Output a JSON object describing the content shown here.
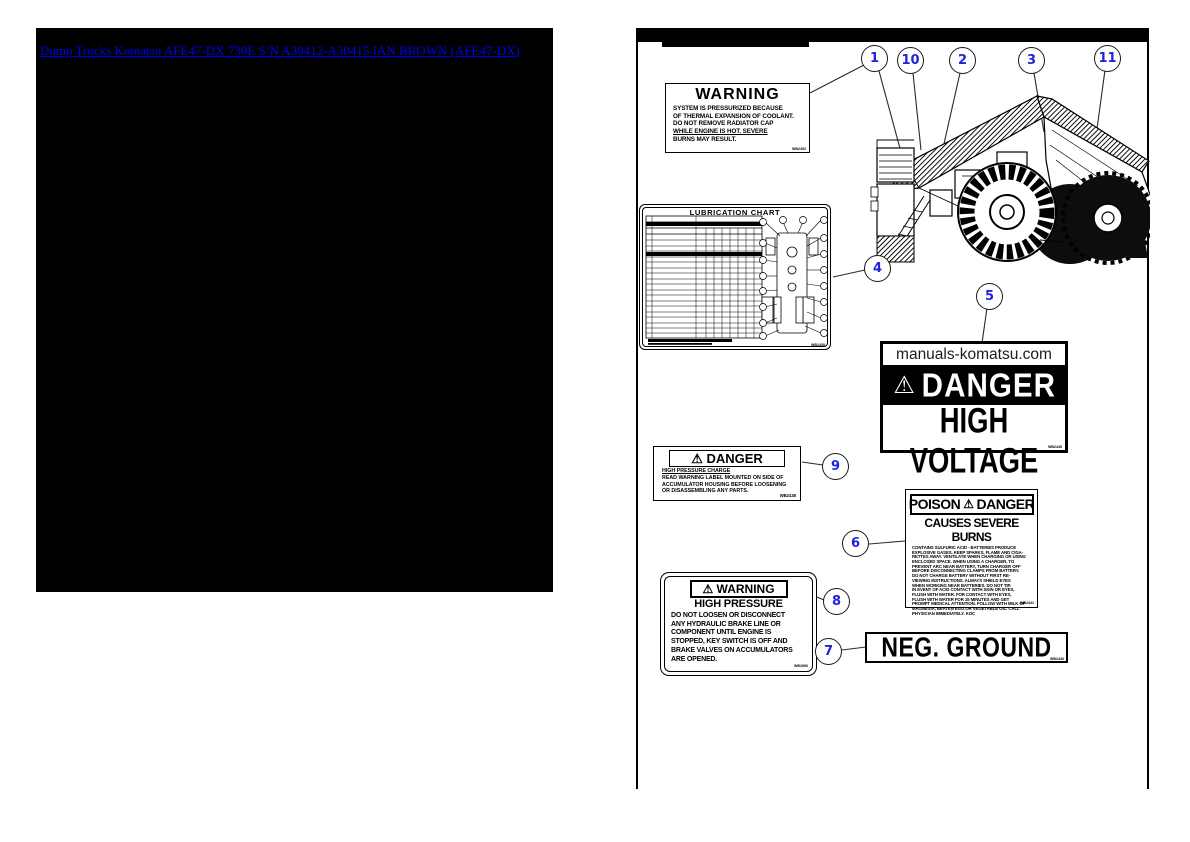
{
  "colors": {
    "link_blue": "#0000EE",
    "callout_blue": "#2222DD",
    "ink": "#000000"
  },
  "left_panel": {
    "link_text": "Dump Trucks Komatsu AFE47-DX 730E S/N A30412-A30415 IAN BROWN (AFE47-DX)"
  },
  "diagram": {
    "callouts": [
      {
        "id": "1"
      },
      {
        "id": "10"
      },
      {
        "id": "2"
      },
      {
        "id": "3"
      },
      {
        "id": "11"
      },
      {
        "id": "4"
      },
      {
        "id": "5"
      },
      {
        "id": "9"
      },
      {
        "id": "6"
      },
      {
        "id": "8"
      },
      {
        "id": "7"
      }
    ],
    "labels": {
      "warning_radiator": {
        "title": "WARNING",
        "lines": [
          "SYSTEM IS PRESSURIZED BECAUSE",
          "OF THERMAL EXPANSION OF COOLANT.",
          "DO NOT REMOVE RADIATOR CAP",
          "WHILE ENGINE IS HOT. SEVERE",
          "BURNS MAY RESULT.",
          ""
        ],
        "code": "WB2452"
      },
      "lubrication_chart": {
        "title": "LUBRICATION CHART",
        "code": "WB2430"
      },
      "high_voltage": {
        "watermark": "manuals-komatsu.com",
        "triangle": "⚠",
        "warning_word": "DANGER",
        "message": "HIGH VOLTAGE",
        "code": "WB2445"
      },
      "accumulator": {
        "triangle": "⚠",
        "warning_word": "DANGER",
        "subtitle": "HIGH PRESSURE CHARGE",
        "lines": [
          "READ WARNING LABEL MOUNTED ON SIDE OF",
          "ACCUMULATOR HOUSING BEFORE LOOSENING",
          "OR DISASSEMBLING ANY PARTS."
        ],
        "code": "WB2438"
      },
      "poison": {
        "title_left": "POISON",
        "triangle": "⚠",
        "title_right": "DANGER",
        "subtitle": "CAUSES SEVERE BURNS",
        "body": "CONTAINS SULFURIC ACID - BATTERIES PRODUCE\nEXPLOSIVE GASES. KEEP SPARKS, FLAME AND CIGA-\nRETTES AWAY. VENTILATE WHEN CHARGING OR USING\nENCLOSED SPACE. WHEN USING A CHARGER, TO\nPREVENT ARC NEAR BATTERY, TURN CHARGER OFF\nBEFORE DISCONNECTING CLAMPS FROM BATTERY.\nDO NOT CHARGE BATTERY WITHOUT FIRST RE-\nVIEWING INSTRUCTIONS. ALWAYS SHIELD EYES\nWHEN WORKING NEAR BATTERIES. DO NOT TIP.\nIN EVENT OF ACID CONTACT WITH SKIN OR EYES,\nFLUSH WITH WATER. FOR CONTACT WITH EYES,\nFLUSH WITH WATER FOR 15 MINUTES AND GET\nPROMPT MEDICAL ATTENTION. FOLLOW WITH MILK OF\nMAGNESIA, BEATEN EGG OR VEGETABLE OIL. CALL\nPHYSICIAN IMMEDIATELY.   KOC",
        "code": "WB2441"
      },
      "high_pressure": {
        "triangle": "⚠",
        "warning_word": "WARNING",
        "subtitle": "HIGH PRESSURE",
        "lines": [
          "DO NOT LOOSEN OR DISCONNECT",
          "ANY HYDRAULIC BRAKE LINE OR",
          "COMPONENT UNTIL ENGINE IS",
          "STOPPED, KEY SWITCH IS OFF AND",
          "BRAKE VALVES ON ACCUMULATORS",
          "ARE OPENED."
        ],
        "code": "WB2896"
      },
      "neg_ground": {
        "text": "NEG. GROUND",
        "code": "WB2446"
      }
    }
  }
}
